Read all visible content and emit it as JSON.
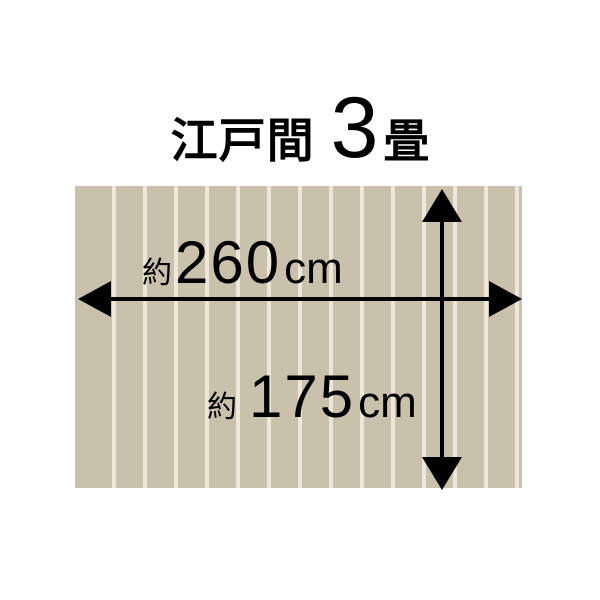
{
  "title": {
    "size_name": "江戸間",
    "mat_count": "3",
    "mat_unit": "畳"
  },
  "dimensions": {
    "width": {
      "approx_prefix": "約",
      "value": "260",
      "unit": "cm"
    },
    "height": {
      "approx_prefix": "約",
      "value": "175",
      "unit": "cm"
    }
  },
  "icons": {
    "arrowhead_left": "left-pointing solid triangle",
    "arrowhead_right": "right-pointing solid triangle",
    "arrowhead_up": "up-pointing solid triangle",
    "arrowhead_down": "down-pointing solid triangle"
  },
  "colors": {
    "background": "#ffffff",
    "plank": "#c9c1ac",
    "plank-gap": "#ece7d8",
    "ink": "#000000"
  }
}
